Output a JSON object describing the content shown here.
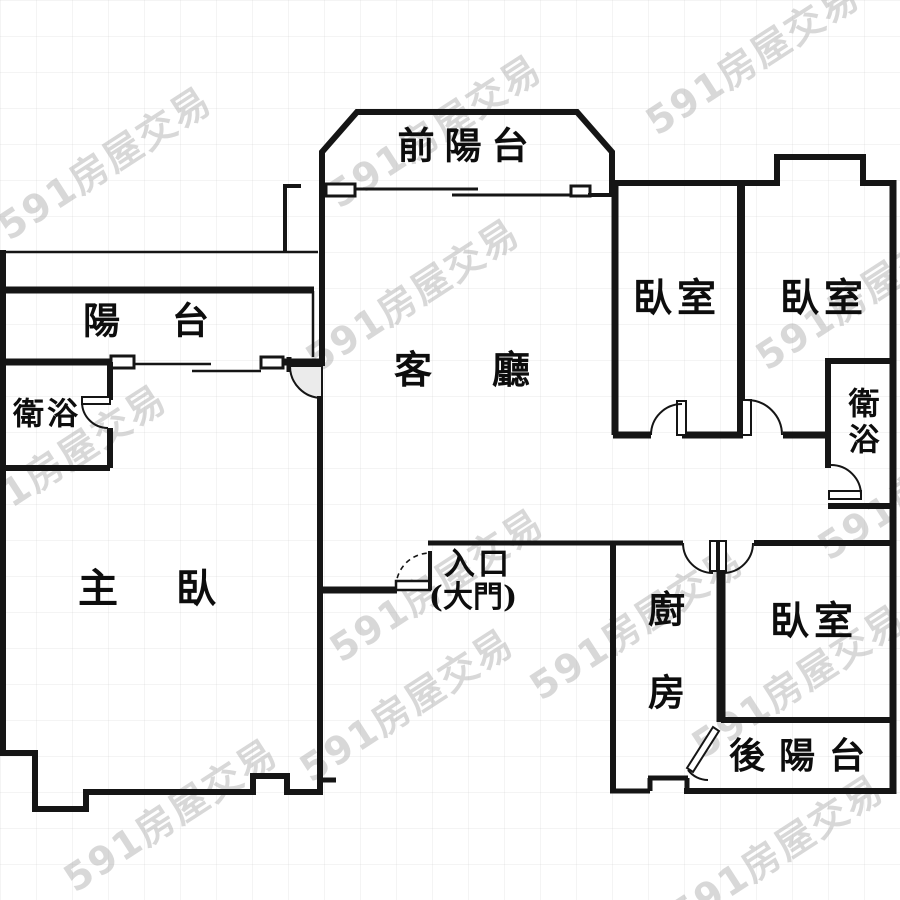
{
  "title": "apartment floor plan",
  "watermark": {
    "text": "591房屋交易"
  },
  "colors": {
    "wall": "#151515",
    "background": "#ffffff",
    "door_swing_shade": "#ebebeb",
    "watermark": "#a8a8a8"
  },
  "rooms": {
    "front_balcony": "前陽台",
    "balcony": "陽台",
    "living_room": "客廳",
    "bath_left": "衛浴",
    "master_bedroom": "主臥",
    "bedroom_top_left": "臥室",
    "bedroom_top_right": "臥室",
    "bath_right": "衛浴",
    "kitchen": "廚房",
    "bedroom_right": "臥室",
    "rear_balcony": "後陽台",
    "entrance_line1": "入口",
    "entrance_line2": "(大門)"
  }
}
